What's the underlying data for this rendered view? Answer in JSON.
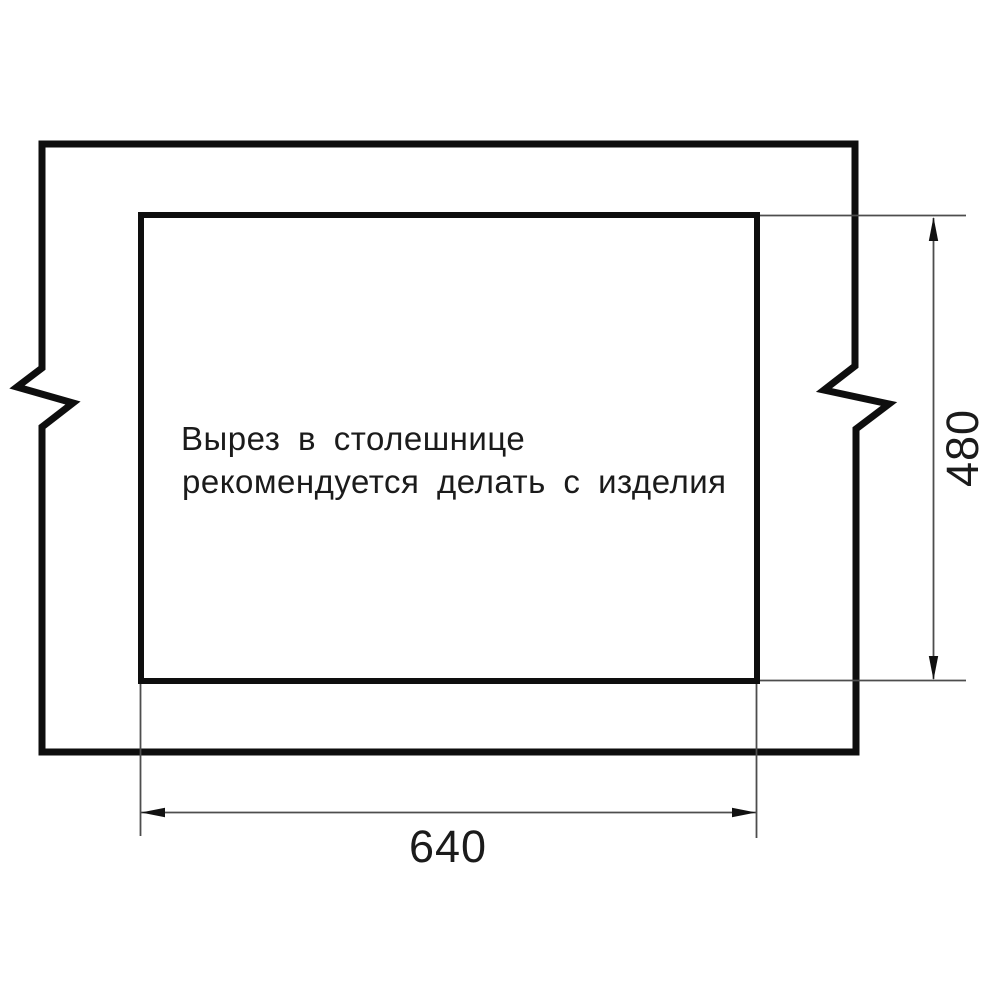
{
  "drawing": {
    "title": "countertop-cutout-drawing",
    "note_line1": "Вырез в столешнице",
    "note_line2": "рекомендуется делать с изделия",
    "width_dimension": {
      "label": "640",
      "unit": "mm"
    },
    "height_dimension": {
      "label": "480",
      "unit": "mm"
    }
  },
  "colors": {
    "background": "#ffffff",
    "outline": "#0e0e0e",
    "cutout": "#0e0e0e",
    "dimension_line": "#4d4d4d",
    "arrow": "#111111",
    "text": "#1b1b1b"
  }
}
